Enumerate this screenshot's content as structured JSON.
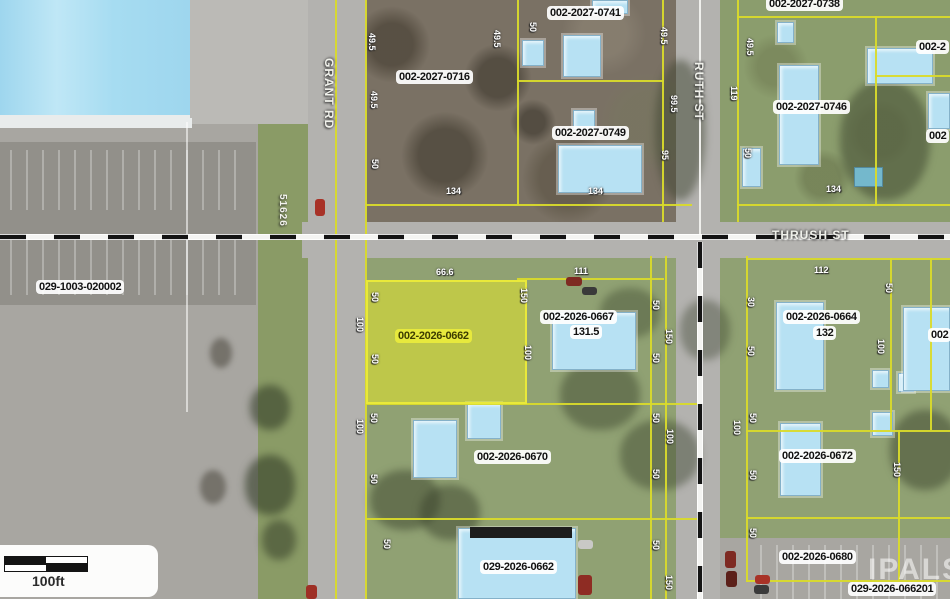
{
  "map": {
    "streets": [
      {
        "name": "GRANT RD",
        "x": 336,
        "y": 58,
        "orientation": "vertical"
      },
      {
        "name": "RUTH ST",
        "x": 706,
        "y": 62,
        "orientation": "vertical"
      },
      {
        "name": "THRUSH ST",
        "x": 772,
        "y": 228,
        "orientation": "horizontal"
      }
    ],
    "address_marker": {
      "text": "51626"
    },
    "highlighted_parcel_id": "002-2026-0662",
    "parcel_labels": [
      {
        "text": "029-1003-020002",
        "x": 36,
        "y": 280,
        "style": "white"
      },
      {
        "text": "002-2027-0716",
        "x": 396,
        "y": 70,
        "style": "white"
      },
      {
        "text": "002-2027-0741",
        "x": 547,
        "y": 6,
        "style": "white"
      },
      {
        "text": "002-2027-0749",
        "x": 552,
        "y": 126,
        "style": "white"
      },
      {
        "text": "002-2027-0738",
        "x": 766,
        "y": -3,
        "style": "white"
      },
      {
        "text": "002-2027-0746",
        "x": 773,
        "y": 100,
        "style": "white"
      },
      {
        "text": "002-2026-0662",
        "x": 395,
        "y": 329,
        "style": "highlight"
      },
      {
        "text": "002-2026-0667",
        "x": 540,
        "y": 310,
        "style": "white"
      },
      {
        "text": "131.5",
        "x": 570,
        "y": 325,
        "style": "white"
      },
      {
        "text": "002-2026-0664",
        "x": 783,
        "y": 310,
        "style": "white"
      },
      {
        "text": "132",
        "x": 813,
        "y": 326,
        "style": "white"
      },
      {
        "text": "002-2026-0670",
        "x": 474,
        "y": 450,
        "style": "white"
      },
      {
        "text": "029-2026-0662",
        "x": 480,
        "y": 560,
        "style": "white"
      },
      {
        "text": "002-2026-0672",
        "x": 779,
        "y": 449,
        "style": "white"
      },
      {
        "text": "002-2026-0680",
        "x": 779,
        "y": 550,
        "style": "white"
      },
      {
        "text": "029-2026-066201",
        "x": 848,
        "y": 582,
        "style": "white"
      },
      {
        "text": "002-2",
        "x": 916,
        "y": 40,
        "style": "white"
      },
      {
        "text": "002",
        "x": 926,
        "y": 129,
        "style": "white"
      },
      {
        "text": "002",
        "x": 928,
        "y": 328,
        "style": "white"
      }
    ],
    "dimension_labels": [
      {
        "text": "49.5",
        "x": 366,
        "y": 33,
        "rot": "v"
      },
      {
        "text": "49.5",
        "x": 368,
        "y": 91,
        "rot": "v"
      },
      {
        "text": "50",
        "x": 369,
        "y": 159,
        "rot": "v"
      },
      {
        "text": "49.5",
        "x": 491,
        "y": 30,
        "rot": "v"
      },
      {
        "text": "50",
        "x": 527,
        "y": 22,
        "rot": "v"
      },
      {
        "text": "49.5",
        "x": 658,
        "y": 27,
        "rot": "v"
      },
      {
        "text": "99.5",
        "x": 668,
        "y": 95,
        "rot": "v"
      },
      {
        "text": "95",
        "x": 659,
        "y": 150,
        "rot": "v"
      },
      {
        "text": "49.5",
        "x": 744,
        "y": 38,
        "rot": "v"
      },
      {
        "text": "119",
        "x": 728,
        "y": 86,
        "rot": "v"
      },
      {
        "text": "50",
        "x": 742,
        "y": 148,
        "rot": "v"
      },
      {
        "text": "134",
        "x": 446,
        "y": 187,
        "rot": "h"
      },
      {
        "text": "134",
        "x": 588,
        "y": 187,
        "rot": "h"
      },
      {
        "text": "134",
        "x": 826,
        "y": 185,
        "rot": "h"
      },
      {
        "text": "66.6",
        "x": 436,
        "y": 268,
        "rot": "h"
      },
      {
        "text": "111",
        "x": 574,
        "y": 267,
        "rot": "h"
      },
      {
        "text": "112",
        "x": 814,
        "y": 266,
        "rot": "h"
      },
      {
        "text": "50",
        "x": 369,
        "y": 292,
        "rot": "v"
      },
      {
        "text": "100",
        "x": 354,
        "y": 317,
        "rot": "v"
      },
      {
        "text": "50",
        "x": 369,
        "y": 354,
        "rot": "v"
      },
      {
        "text": "150",
        "x": 518,
        "y": 288,
        "rot": "v"
      },
      {
        "text": "100",
        "x": 522,
        "y": 345,
        "rot": "v"
      },
      {
        "text": "50",
        "x": 650,
        "y": 300,
        "rot": "v"
      },
      {
        "text": "150",
        "x": 663,
        "y": 329,
        "rot": "v"
      },
      {
        "text": "50",
        "x": 650,
        "y": 353,
        "rot": "v"
      },
      {
        "text": "30",
        "x": 745,
        "y": 297,
        "rot": "v"
      },
      {
        "text": "50",
        "x": 883,
        "y": 283,
        "rot": "v"
      },
      {
        "text": "100",
        "x": 875,
        "y": 339,
        "rot": "v"
      },
      {
        "text": "50",
        "x": 745,
        "y": 346,
        "rot": "v"
      },
      {
        "text": "50",
        "x": 368,
        "y": 413,
        "rot": "v"
      },
      {
        "text": "100",
        "x": 354,
        "y": 419,
        "rot": "v"
      },
      {
        "text": "50",
        "x": 368,
        "y": 474,
        "rot": "v"
      },
      {
        "text": "50",
        "x": 650,
        "y": 413,
        "rot": "v"
      },
      {
        "text": "100",
        "x": 664,
        "y": 429,
        "rot": "v"
      },
      {
        "text": "50",
        "x": 650,
        "y": 469,
        "rot": "v"
      },
      {
        "text": "100",
        "x": 731,
        "y": 420,
        "rot": "v"
      },
      {
        "text": "50",
        "x": 747,
        "y": 413,
        "rot": "v"
      },
      {
        "text": "50",
        "x": 747,
        "y": 470,
        "rot": "v"
      },
      {
        "text": "150",
        "x": 891,
        "y": 462,
        "rot": "v"
      },
      {
        "text": "50",
        "x": 747,
        "y": 528,
        "rot": "v"
      },
      {
        "text": "50",
        "x": 381,
        "y": 539,
        "rot": "v"
      },
      {
        "text": "50",
        "x": 650,
        "y": 540,
        "rot": "v"
      },
      {
        "text": "150",
        "x": 663,
        "y": 575,
        "rot": "v"
      }
    ],
    "watermark": "IPALS",
    "scale": {
      "label": "100ft"
    },
    "colors": {
      "parcel_line": "#d9da2b",
      "highlight_fill": "#e4e828",
      "building_roof": "#b7e1f3",
      "road": "#b3b2af",
      "label_bg": "#ffffff",
      "highlight_label_bg": "#e9eb3c"
    }
  }
}
